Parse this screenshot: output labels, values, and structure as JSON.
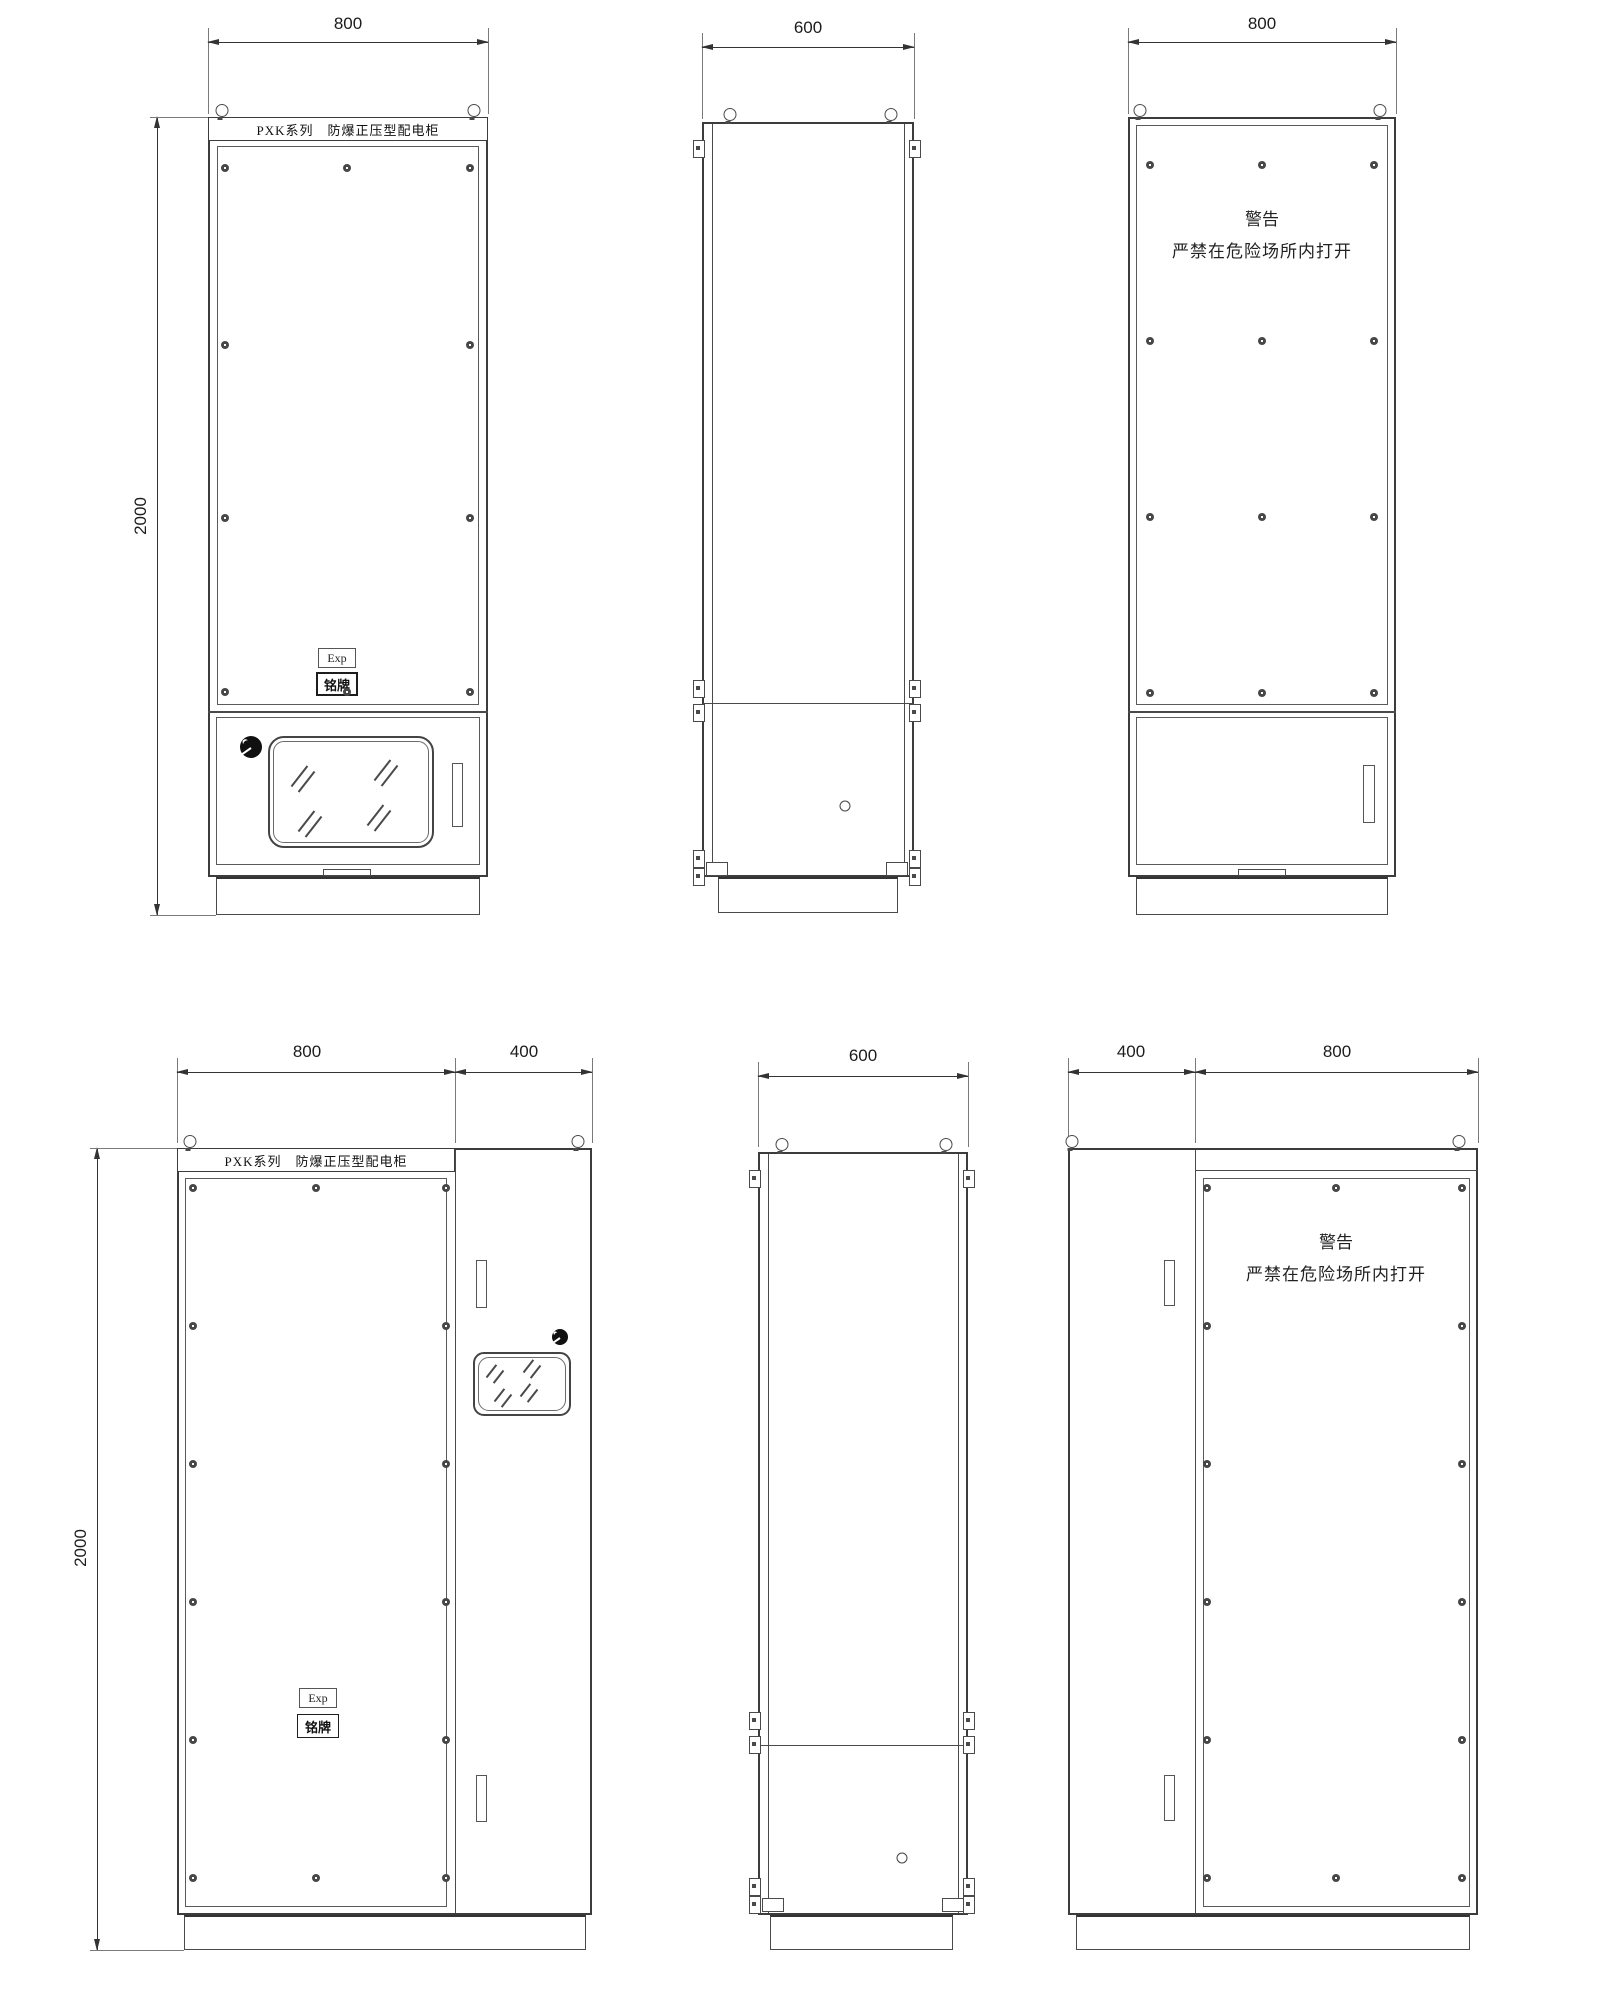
{
  "labels": {
    "series_title": "PXK系列　防爆正压型配电柜",
    "warning_line1": "警告",
    "warning_line2": "严禁在危险场所内打开",
    "exp": "Exp",
    "nameplate": "铭牌"
  },
  "views": {
    "front_top": {
      "width": "800",
      "height": "2000"
    },
    "side_top": {
      "width": "600"
    },
    "rear_top": {
      "width": "800"
    },
    "front_bottom": {
      "width": "800",
      "side_width": "400",
      "height": "2000"
    },
    "side_bottom": {
      "width": "600"
    },
    "rear_bottom": {
      "side_width": "400",
      "width": "800"
    }
  }
}
